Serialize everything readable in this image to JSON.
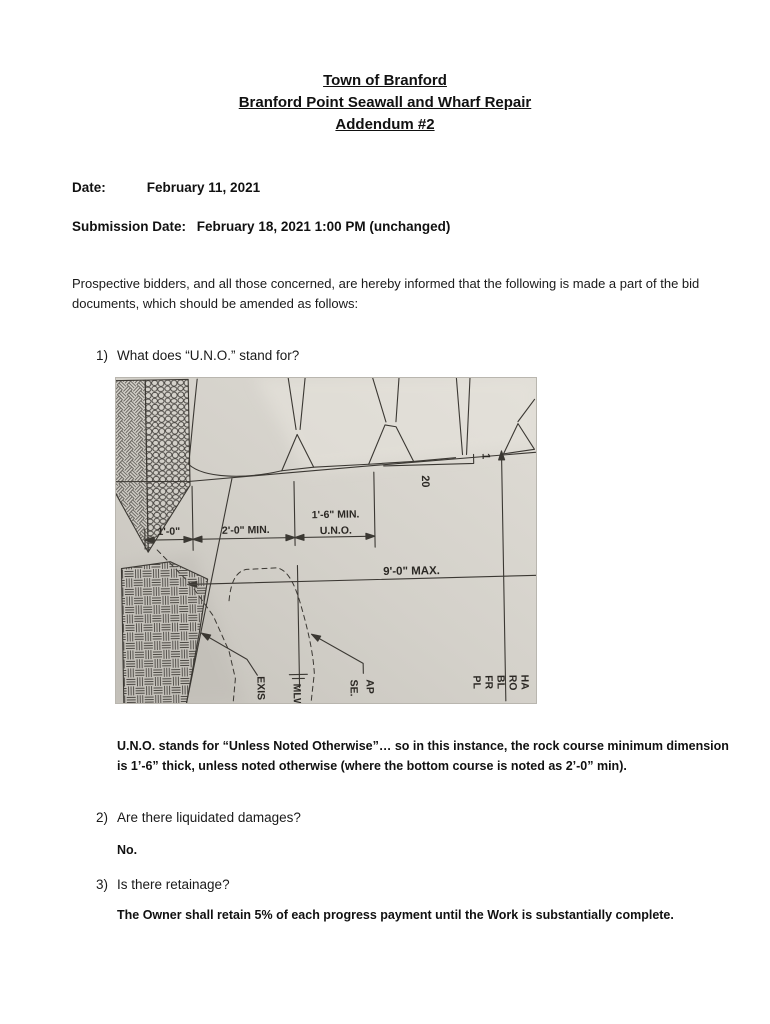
{
  "title": {
    "line1": "Town of Branford",
    "line2": "Branford Point Seawall and Wharf Repair",
    "line3": "Addendum #2"
  },
  "meta": {
    "date_label": "Date:",
    "date_value": "February 11, 2021",
    "submission_label": "Submission Date:",
    "submission_value": "February 18, 2021 1:00 PM (unchanged)"
  },
  "intro": "Prospective bidders, and all those concerned, are hereby informed that the following is made a part of the bid documents, which should be amended as follows:",
  "questions": [
    {
      "number": "1)",
      "question": "What does “U.N.O.” stand for?",
      "answer": "U.N.O. stands for “Unless Noted Otherwise”… so in this instance, the rock course minimum dimension is 1’-6” thick, unless noted otherwise (where the bottom course is noted as 2’-0” min)."
    },
    {
      "number": "2)",
      "question": "Are there liquidated damages?",
      "answer": "No."
    },
    {
      "number": "3)",
      "question": "Is there retainage?",
      "answer": "The Owner shall retain 5% of each progress payment until the Work is substantially complete."
    }
  ],
  "drawing": {
    "labels": {
      "dim_left": "1'-0\"",
      "dim_mid": "2'-0\" MIN.",
      "dim_right_1": "1'-6\" MIN.",
      "dim_right_2": "U.N.O.",
      "dim_max": "9'-0\" MAX.",
      "slope_run": "20",
      "slope_rise": "1",
      "cut": [
        "EXIS",
        "MLW",
        "SE.",
        "AP",
        "PL",
        "FR",
        "BL",
        "RO",
        "HA"
      ]
    },
    "colors": {
      "paper": "#d3d0c9",
      "line": "#3b3833"
    }
  }
}
